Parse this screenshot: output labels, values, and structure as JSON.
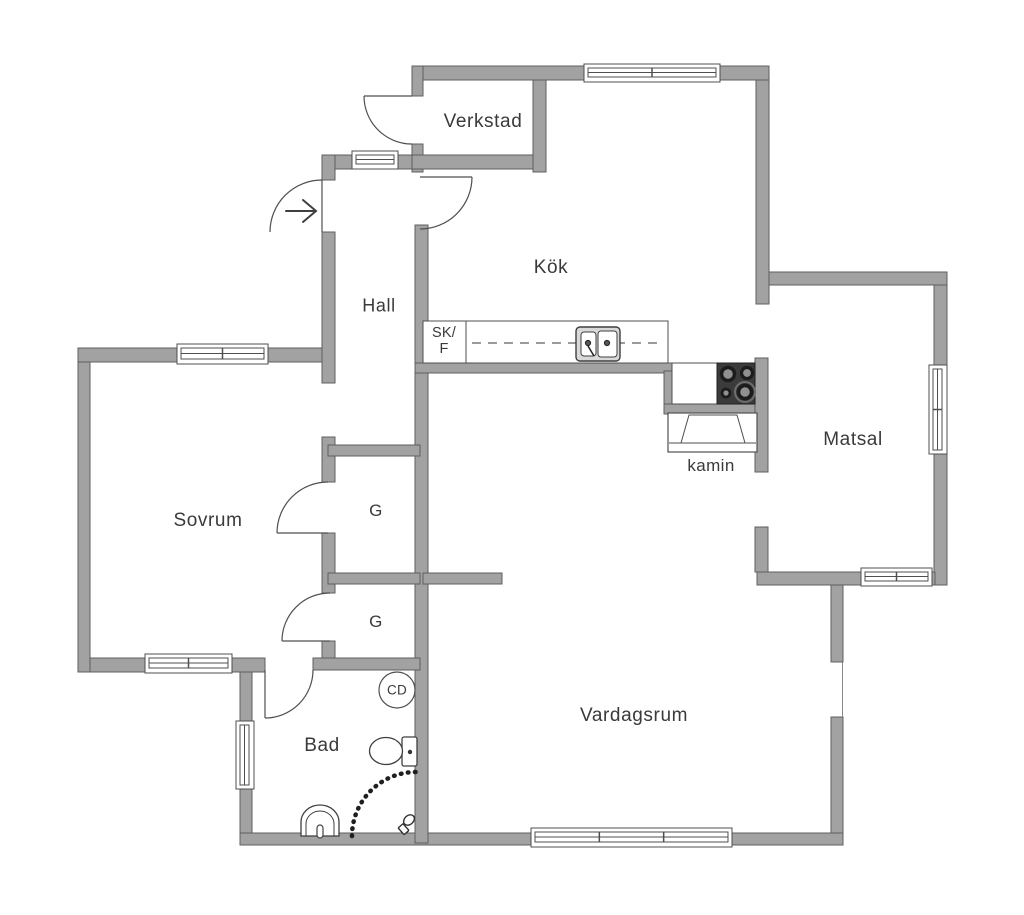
{
  "floorplan": {
    "title": "Apartment floor plan",
    "rooms": [
      {
        "id": "verkstad",
        "label": "Verkstad"
      },
      {
        "id": "kok",
        "label": "Kök"
      },
      {
        "id": "hall",
        "label": "Hall"
      },
      {
        "id": "sovrum",
        "label": "Sovrum"
      },
      {
        "id": "matsal",
        "label": "Matsal"
      },
      {
        "id": "vardagsrum",
        "label": "Vardagsrum"
      },
      {
        "id": "bad",
        "label": "Bad"
      },
      {
        "id": "closet1",
        "label": "G"
      },
      {
        "id": "closet2",
        "label": "G"
      },
      {
        "id": "kamin",
        "label": "kamin"
      },
      {
        "id": "skf",
        "label": "SK/",
        "label2": "F"
      },
      {
        "id": "cd",
        "label": "CD"
      }
    ],
    "fixtures": [
      "entry-arrow",
      "kitchen-counter",
      "double-sink",
      "stove",
      "fireplace",
      "toilet",
      "washbasin",
      "shower",
      "wardrobe-doors",
      "windows"
    ],
    "colors": {
      "wall_fill": "#a2a2a2",
      "wall_outline": "#5f5f5f",
      "line": "#4f4f4f",
      "text": "#3a3a3a",
      "cooktop": "#3b3b3b",
      "burner_ring": "#1c1c1c",
      "burner_fill": "#909090",
      "dash": "#9a9a9a"
    }
  }
}
